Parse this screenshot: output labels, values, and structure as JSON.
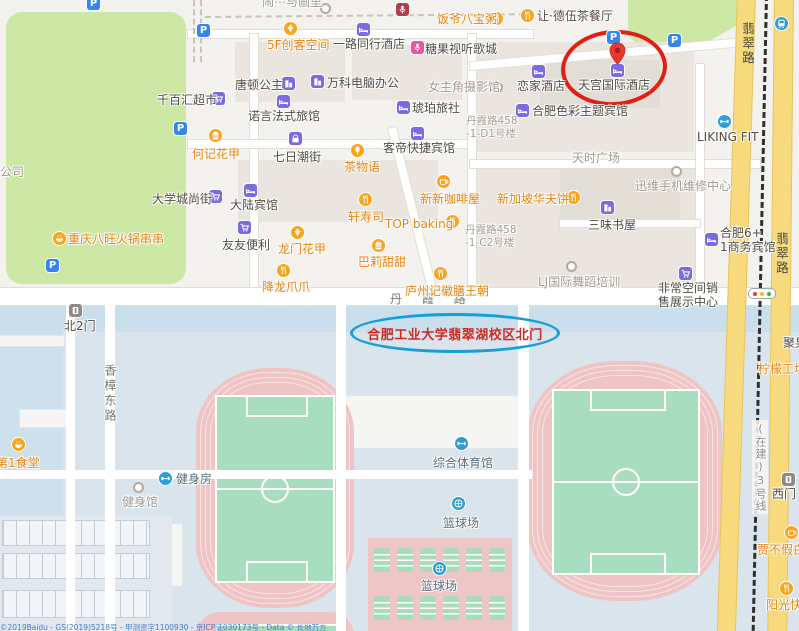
{
  "map_type": "street-map",
  "colors": {
    "highlight_red": "#e41e14",
    "highlight_blue": "#179ed8",
    "road_yellow": "#f7d97e",
    "park_green": "#cde7a5",
    "campus_blue": "#d9e4ec",
    "track_pink": "#efc4c4",
    "field_green": "#a9ddc0",
    "poi_orange": "#e8820e",
    "poi_purple": "#7a6ae4",
    "poi_blue": "#2d9fd4"
  },
  "highlights": {
    "hotel_circle_target": "天宫国际酒店",
    "campus_gate_text": "合肥工业大学翡翠湖校区北门"
  },
  "roads": {
    "danxia": "丹 霞 路",
    "xiangzhang_donglu": "香樟东路",
    "feicui_lu": "翡翠路",
    "metro_line3": "(在建)3号线"
  },
  "parking_glyph": "P",
  "parking_icons": [
    [
      93,
      3
    ],
    [
      203,
      30
    ],
    [
      180,
      128
    ],
    [
      52,
      265
    ],
    [
      613,
      37
    ],
    [
      674,
      40
    ]
  ],
  "standalone_dots": [
    [
      496,
      86
    ],
    [
      324,
      7
    ]
  ],
  "copyright": "©2019Baidu - GS(2019)5218号 - 甲测资字1100930 - 京ICP证030173号 - Data © 长地万方",
  "pois": [
    {
      "t": "闹⋯与画里",
      "x": 262,
      "y": -5,
      "c": "gray"
    },
    {
      "t": "",
      "x": 402,
      "y": 9,
      "i": "mic",
      "ic": "red"
    },
    {
      "t": "饭爷八宝粥",
      "x": 437,
      "y": 12,
      "c": "food",
      "i": "fork",
      "ic": "food",
      "ix": 496,
      "iy": 18
    },
    {
      "t": "让·德伍茶餐厅",
      "x": 537,
      "y": 9,
      "c": "dark",
      "i": "fork",
      "ic": "food",
      "ix": 527,
      "iy": 15
    },
    {
      "t": "5F创客空间",
      "x": 267,
      "y": 38,
      "c": "food",
      "i": "dessert",
      "ic": "food",
      "ix": 290,
      "iy": 28
    },
    {
      "t": "一路同行酒店",
      "x": 333,
      "y": 37,
      "c": "dark",
      "i": "bed",
      "ic": "purple",
      "ix": 363,
      "iy": 29
    },
    {
      "t": "糖果视听歌城",
      "x": 425,
      "y": 42,
      "c": "dark",
      "i": "mic",
      "ic": "pink",
      "ix": 417,
      "iy": 47
    },
    {
      "t": "天宫国际酒店",
      "x": 578,
      "y": 78,
      "c": "dark",
      "i": "bed",
      "ic": "purple",
      "ix": 617,
      "iy": 70
    },
    {
      "t": "恋家酒店",
      "x": 517,
      "y": 79,
      "c": "dark",
      "i": "bed",
      "ic": "purple",
      "ix": 538,
      "iy": 71
    },
    {
      "t": "唐顿公主",
      "x": 235,
      "y": 78,
      "c": "dark",
      "i": "building",
      "ic": "purple",
      "ix": 288,
      "iy": 83
    },
    {
      "t": "万科电脑办公",
      "x": 327,
      "y": 76,
      "c": "dark",
      "i": "building",
      "ic": "purple",
      "ix": 317,
      "iy": 81
    },
    {
      "t": "女主角摄影馆",
      "x": 428,
      "y": 80,
      "c": "gray"
    },
    {
      "t": "千百汇超市",
      "x": 157,
      "y": 93,
      "c": "dark",
      "i": "cart",
      "ic": "purple",
      "ix": 218,
      "iy": 98
    },
    {
      "t": "诺言法式旅馆",
      "x": 248,
      "y": 109,
      "c": "dark",
      "i": "bed",
      "ic": "purple",
      "ix": 283,
      "iy": 101
    },
    {
      "t": "琥珀旅社",
      "x": 412,
      "y": 101,
      "c": "dark",
      "i": "bed",
      "ic": "purple",
      "ix": 403,
      "iy": 107
    },
    {
      "t": "合肥色彩主题宾馆",
      "x": 532,
      "y": 104,
      "c": "dark",
      "i": "bed",
      "ic": "purple",
      "ix": 522,
      "iy": 110
    },
    {
      "t": "丹霞路458\n-1-D1号楼",
      "x": 466,
      "y": 115,
      "c": "graysm ml"
    },
    {
      "t": "LIKING FIT",
      "x": 697,
      "y": 130,
      "c": "dark",
      "i": "gym",
      "ic": "blue",
      "ix": 724,
      "iy": 121
    },
    {
      "t": "何记花甲",
      "x": 192,
      "y": 147,
      "c": "food",
      "i": "burger",
      "ic": "food",
      "ix": 215,
      "iy": 135
    },
    {
      "t": "七日潮街",
      "x": 273,
      "y": 150,
      "c": "dark",
      "i": "bag",
      "ic": "purple",
      "ix": 295,
      "iy": 138
    },
    {
      "t": "茶物语",
      "x": 344,
      "y": 160,
      "c": "food",
      "i": "popsicle",
      "ic": "food",
      "ix": 357,
      "iy": 150
    },
    {
      "t": "客帝快捷宾馆",
      "x": 383,
      "y": 141,
      "c": "dark",
      "i": "bed",
      "ic": "purple",
      "ix": 417,
      "iy": 133
    },
    {
      "t": "天时广场",
      "x": 572,
      "y": 151,
      "c": "gray"
    },
    {
      "t": "公司",
      "x": 0,
      "y": 165,
      "c": "gray"
    },
    {
      "t": "大学城尚街",
      "x": 152,
      "y": 192,
      "c": "dark",
      "i": "cart",
      "ic": "purple",
      "ix": 215,
      "iy": 196
    },
    {
      "t": "迅维手机维修中心",
      "x": 635,
      "y": 179,
      "c": "gray",
      "i": "dot",
      "ic": "dot",
      "ix": 677,
      "iy": 172
    },
    {
      "t": "新新咖啡屋",
      "x": 420,
      "y": 192,
      "c": "food",
      "i": "coffee",
      "ic": "food",
      "ix": 443,
      "iy": 181
    },
    {
      "t": "新加坡华夫饼",
      "x": 497,
      "y": 192,
      "c": "food",
      "i": "fork",
      "ic": "food",
      "ix": 573,
      "iy": 197
    },
    {
      "t": "大陆宾馆",
      "x": 230,
      "y": 198,
      "c": "dark",
      "i": "bed",
      "ic": "purple",
      "ix": 250,
      "iy": 190
    },
    {
      "t": "轩寿司",
      "x": 348,
      "y": 210,
      "c": "food",
      "i": "fork",
      "ic": "food",
      "ix": 365,
      "iy": 199
    },
    {
      "t": "TOP baking",
      "x": 385,
      "y": 217,
      "c": "food",
      "i": "fork",
      "ic": "food",
      "ix": 452,
      "iy": 221
    },
    {
      "t": "三味书屋",
      "x": 588,
      "y": 218,
      "c": "dark",
      "i": "building",
      "ic": "purple",
      "ix": 607,
      "iy": 207
    },
    {
      "t": "重庆八旺火锅串串",
      "x": 68,
      "y": 232,
      "c": "food",
      "i": "hotpot",
      "ic": "food",
      "ix": 59,
      "iy": 238
    },
    {
      "t": "友友便利",
      "x": 222,
      "y": 238,
      "c": "dark",
      "i": "cart",
      "ic": "purple",
      "ix": 244,
      "iy": 227
    },
    {
      "t": "龙门花甲",
      "x": 278,
      "y": 242,
      "c": "food",
      "i": "dessert",
      "ic": "food",
      "ix": 297,
      "iy": 232
    },
    {
      "t": "巴莉甜甜",
      "x": 358,
      "y": 255,
      "c": "food",
      "i": "burger",
      "ic": "food",
      "ix": 378,
      "iy": 245
    },
    {
      "t": "合肥6+\n1商务宾馆",
      "x": 720,
      "y": 226,
      "c": "dark ml",
      "i": "bed",
      "ic": "purple",
      "ix": 711,
      "iy": 239
    },
    {
      "t": "丹霞路458\n-1-C2号楼",
      "x": 465,
      "y": 224,
      "c": "graysm ml"
    },
    {
      "t": "降龙爪爪",
      "x": 262,
      "y": 280,
      "c": "food",
      "i": "fork",
      "ic": "food",
      "ix": 283,
      "iy": 270
    },
    {
      "t": "庐州记徽膳王朝",
      "x": 405,
      "y": 284,
      "c": "food",
      "i": "fork",
      "ic": "food",
      "ix": 440,
      "iy": 273
    },
    {
      "t": "LJ国际舞蹈培训",
      "x": 538,
      "y": 275,
      "c": "gray",
      "i": "dot",
      "ic": "dot",
      "ix": 572,
      "iy": 267
    },
    {
      "t": "非常空间销\n售展示中心",
      "x": 658,
      "y": 281,
      "c": "dark ml",
      "i": "cart",
      "ic": "purple",
      "ix": 685,
      "iy": 273
    },
    {
      "t": "聚果缘",
      "x": 783,
      "y": 336,
      "c": "dark"
    },
    {
      "t": "柠檬工坊",
      "x": 758,
      "y": 362,
      "c": "food"
    },
    {
      "t": "北2门",
      "x": 64,
      "y": 319,
      "c": "dark",
      "i": "gate",
      "ic": "gray",
      "ix": 75,
      "iy": 310
    },
    {
      "t": "第1食堂",
      "x": -4,
      "y": 456,
      "c": "food",
      "i": "hotpot",
      "ic": "food",
      "ix": 18,
      "iy": 444
    },
    {
      "t": "健身房",
      "x": 176,
      "y": 472,
      "c": "campus",
      "i": "gym",
      "ic": "blue",
      "ix": 165,
      "iy": 478
    },
    {
      "t": "健身馆",
      "x": 122,
      "y": 495,
      "c": "gray",
      "i": "dot",
      "ic": "dot",
      "ix": 139,
      "iy": 488
    },
    {
      "t": "综合体育馆",
      "x": 433,
      "y": 456,
      "c": "campus",
      "i": "gym",
      "ic": "blue",
      "ix": 461,
      "iy": 443
    },
    {
      "t": "篮球场",
      "x": 443,
      "y": 516,
      "c": "campus",
      "i": "ball",
      "ic": "blue",
      "ix": 458,
      "iy": 503
    },
    {
      "t": "篮球场",
      "x": 421,
      "y": 579,
      "c": "campus",
      "i": "ball",
      "ic": "blue",
      "ix": 439,
      "iy": 568
    },
    {
      "t": "西门",
      "x": 772,
      "y": 487,
      "c": "dark",
      "i": "gate",
      "ic": "gray",
      "ix": 788,
      "iy": 479
    },
    {
      "t": "贾不假白",
      "x": 757,
      "y": 543,
      "c": "food",
      "i": "coffee",
      "ic": "food",
      "ix": 791,
      "iy": 532
    },
    {
      "t": "阳光快餐",
      "x": 766,
      "y": 598,
      "c": "food",
      "i": "fork",
      "ic": "food",
      "ix": 786,
      "iy": 588
    },
    {
      "t": "",
      "x": 781,
      "y": 23,
      "i": "bus",
      "ic": "blue"
    }
  ]
}
